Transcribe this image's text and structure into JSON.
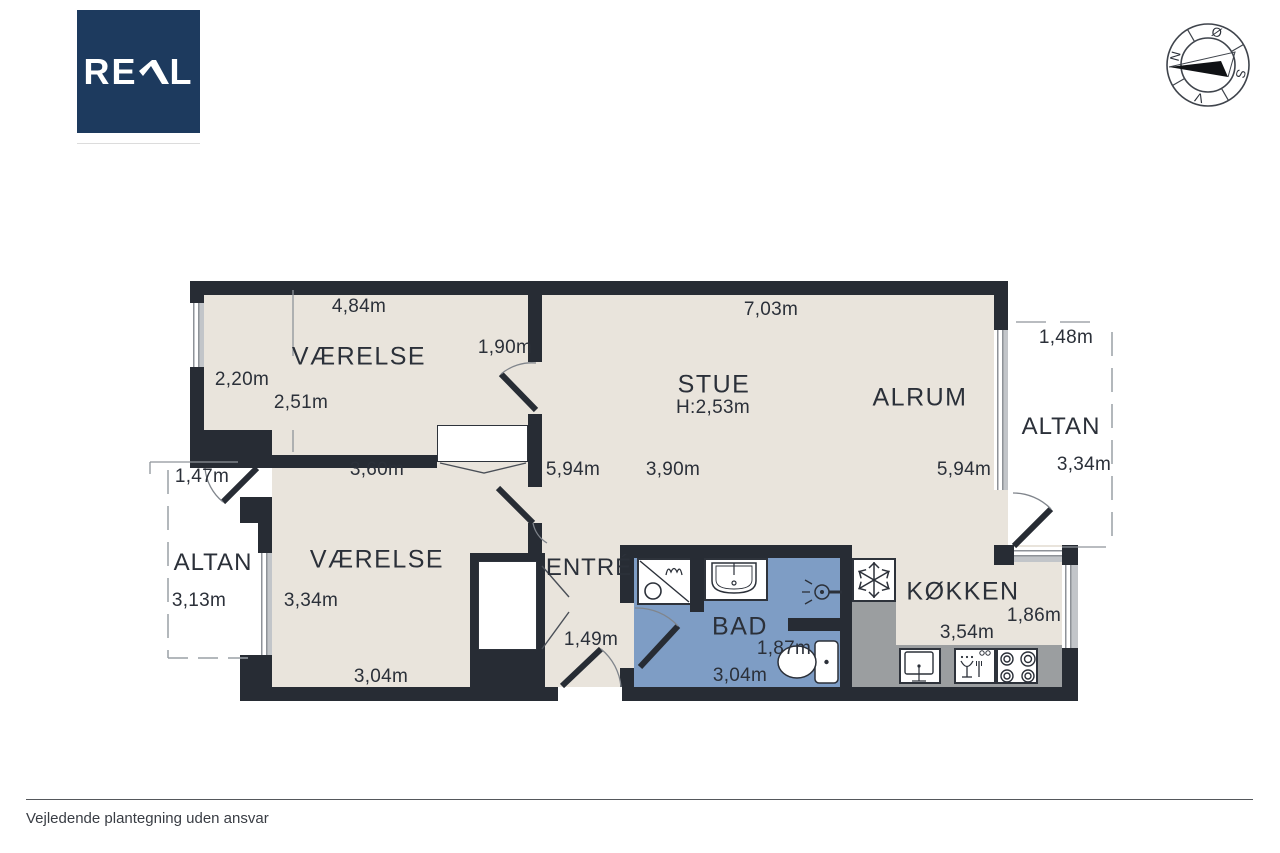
{
  "logo": {
    "text": "REAL",
    "prefix": "RE",
    "suffix": "L"
  },
  "compass": {
    "north": "N",
    "east": "Ø",
    "south": "S",
    "west": "V"
  },
  "plan": {
    "rooms": {
      "vaerelse1": {
        "name": "VÆRELSE",
        "dim_top": "4,84m",
        "dim_left": "2,20m",
        "dim_inner": "2,51m",
        "dim_door": "1,90m",
        "dim_bottom": "3,60m"
      },
      "stue": {
        "name": "STUE",
        "ceiling_height": "H:2,53m",
        "dim_top": "7,03m",
        "dim_left": "5,94m",
        "dim_mid": "3,90m"
      },
      "alrum": {
        "name": "ALRUM",
        "dim_right": "5,94m"
      },
      "altan_right": {
        "name": "ALTAN",
        "dim_top": "1,48m",
        "dim_side": "3,34m"
      },
      "altan_left": {
        "name": "ALTAN",
        "dim_top": "1,47m",
        "dim_side": "3,13m"
      },
      "vaerelse2": {
        "name": "VÆRELSE",
        "dim_side": "3,34m",
        "dim_bottom": "3,04m"
      },
      "entre": {
        "name": "ENTRÉ",
        "dim_door": "1,49m"
      },
      "bad": {
        "name": "BAD",
        "dim_width": "1,87m",
        "dim_bottom": "3,04m"
      },
      "kokken": {
        "name": "KØKKEN",
        "dim_right": "1,86m",
        "dim_bottom": "3,54m"
      }
    }
  },
  "footer": {
    "disclaimer": "Vejledende plantegning uden ansvar"
  },
  "colors": {
    "brand_navy": "#1d3a5e",
    "wall": "#272c34",
    "floor": "#e9e4dc",
    "bath_blue": "#7e9dc5",
    "counter_gray": "#9b9ea0"
  }
}
